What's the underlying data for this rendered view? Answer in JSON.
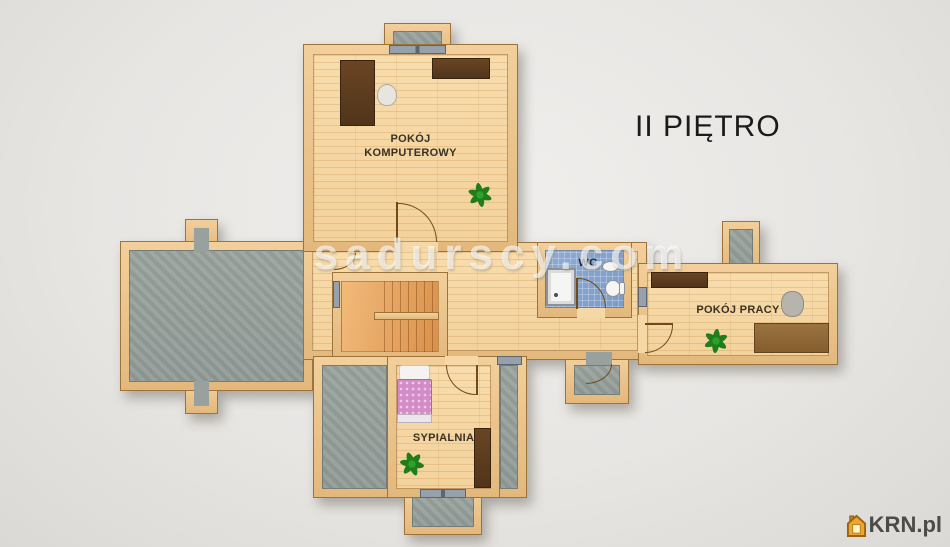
{
  "floor_plan": {
    "floor_label": "II PIĘTRO",
    "watermark": "sadurscy.com",
    "rooms": {
      "computer_room": {
        "label_line1": "POKÓJ",
        "label_line2": "KOMPUTEROWY"
      },
      "wc": {
        "label": "WC"
      },
      "office": {
        "label": "POKÓJ PRACY"
      },
      "bedroom": {
        "label": "SYPIALNIA"
      }
    }
  },
  "branding": {
    "logo_text": "KRN.pl"
  },
  "colors": {
    "wall": "#ecc793",
    "wood_floor": "#f7d9a7",
    "stairs_floor": "#eda963",
    "terrace_floor": "#99a29e",
    "wc_tile": "#84a4cd",
    "plant_green": "#22881e",
    "bed_cover": "#d48cc8",
    "watermark_white": "#ffffff",
    "logo_orange": "#e09a2e",
    "title_text": "#1b1b1b"
  }
}
